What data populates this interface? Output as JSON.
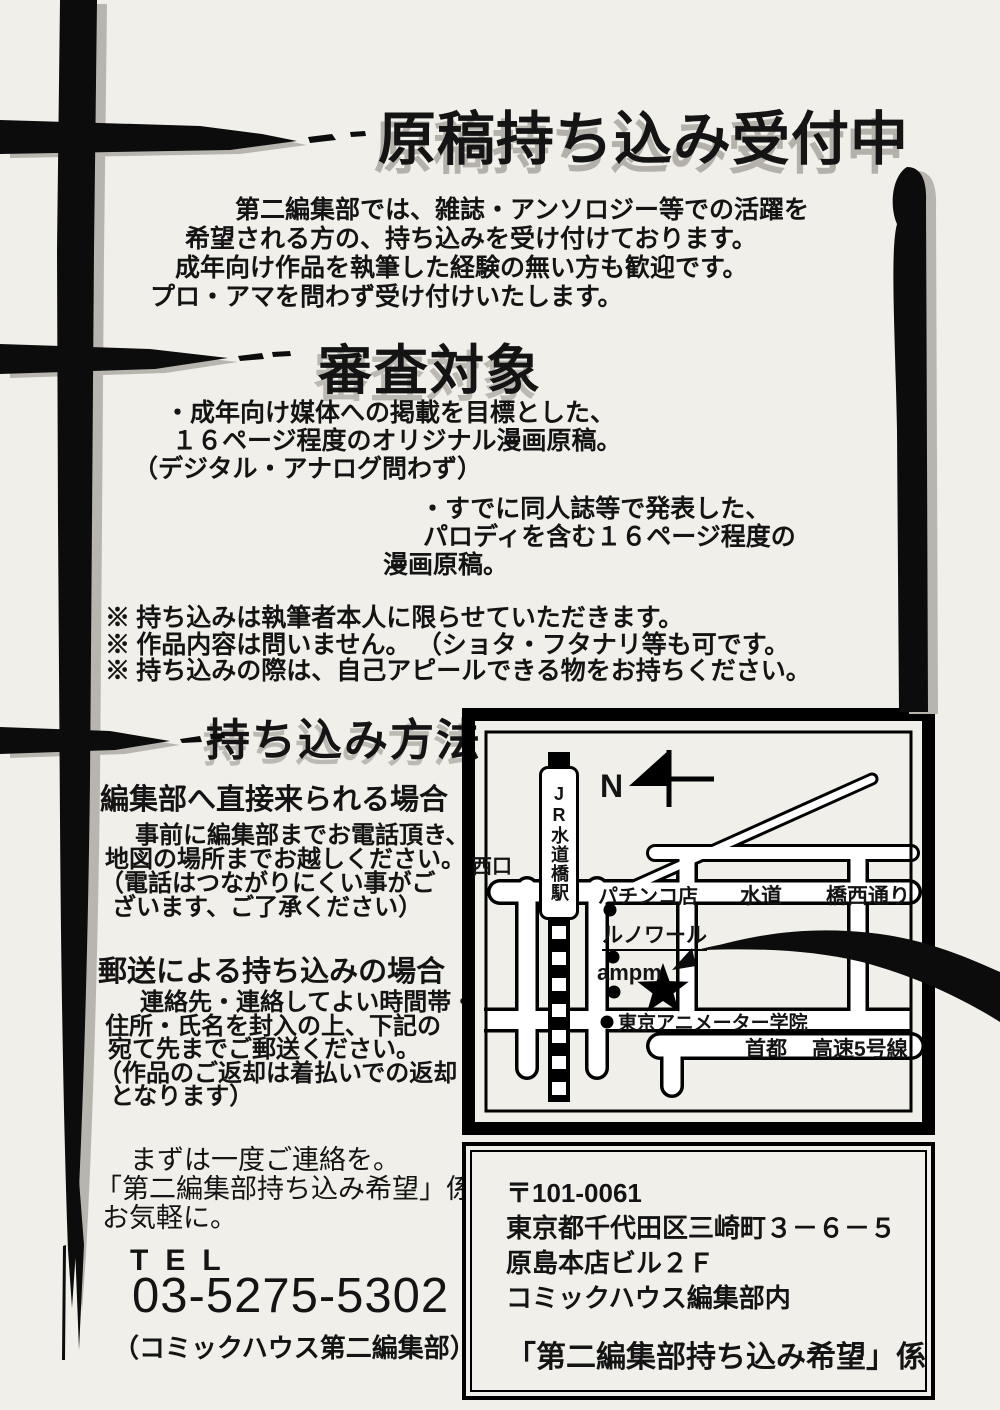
{
  "title": "原稿持ち込み受付中",
  "intro": [
    "第二編集部では、雑誌・アンソロジー等での活躍を",
    "希望される方の、持ち込みを受け付けております。",
    "成年向け作品を執筆した経験の無い方も歓迎です。",
    "プロ・アマを問わず受け付けいたします。"
  ],
  "shinsa": {
    "heading": "審査対象",
    "bullet1": [
      "・成年向け媒体への掲載を目標とした、",
      "１６ページ程度のオリジナル漫画原稿。",
      "（デジタル・アナログ問わず）"
    ],
    "bullet2": [
      "・すでに同人誌等で発表した、",
      "パロディを含む１６ページ程度の",
      "漫画原稿。"
    ],
    "notes": [
      "※ 持ち込みは執筆者本人に限らせていただきます。",
      "※ 作品内容は問いません。 （ショタ・フタナリ等も可です。",
      "※ 持ち込みの際は、自己アピールできる物をお持ちください。"
    ]
  },
  "houhou": {
    "heading": "持ち込み方法",
    "direct_heading": "編集部へ直接来られる場合",
    "direct": [
      "事前に編集部までお電話頂き、",
      "地図の場所までお越しください。",
      "（電話はつながりにくい事がご",
      "ざいます、ご了承ください）"
    ],
    "mail_heading": "郵送による持ち込みの場合",
    "mail": [
      "連絡先・連絡してよい時間帯・",
      "住所・氏名を封入の上、下記の",
      "宛て先までご郵送ください。",
      "（作品のご返却は着払いでの返却",
      "となります）"
    ],
    "contact": [
      "まずは一度ご連絡を。",
      "「第二編集部持ち込み希望」係まで",
      "お気軽に。"
    ],
    "tel_label": "TEL",
    "tel_number": "03-5275-5302",
    "tel_note": "（コミックハウス第二編集部）"
  },
  "map": {
    "compass_n": "N",
    "station": "JR水道橋駅",
    "west_exit": "西口",
    "pachinko": "パチンコ店",
    "suido": "水道",
    "hashi_nishi_dori": "橋西通り",
    "renoir": "ルノワール",
    "ampm": "ampm",
    "animator_school": "東京アニメーター学院",
    "shuto": "首都",
    "kousoku_5": "高速5号線"
  },
  "address": {
    "postal": "〒101-0061",
    "line1": "東京都千代田区三崎町３－６－５",
    "line2": "原島本店ビル２Ｆ",
    "line3": "コミックハウス編集部内",
    "recipient": "「第二編集部持ち込み希望」係"
  },
  "colors": {
    "paper": "#f1efe9",
    "ink": "#141414",
    "shadow": "#b8b5ae"
  }
}
